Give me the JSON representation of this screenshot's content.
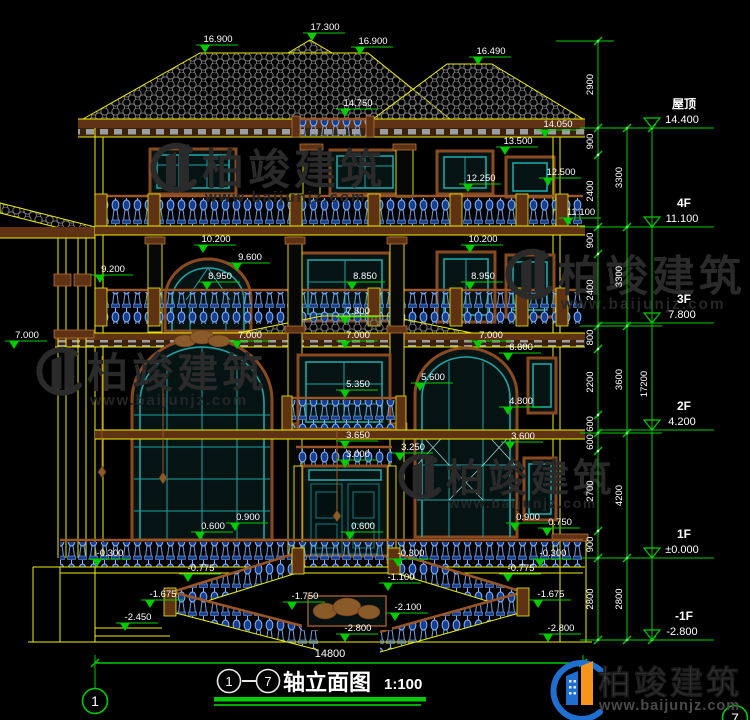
{
  "drawing": {
    "title": "轴立面图",
    "scale": "1:100",
    "axis_start": "1",
    "axis_end": "7",
    "axis_dash": "—",
    "bottom_dim": "14800"
  },
  "levels": [
    {
      "name": "屋顶",
      "value": "14.400",
      "y": 128
    },
    {
      "name": "4F",
      "value": "11.100",
      "y": 227
    },
    {
      "name": "3F",
      "value": "7.800",
      "y": 323
    },
    {
      "name": "2F",
      "value": "4.200",
      "y": 430
    },
    {
      "name": "1F",
      "value": "±0.000",
      "y": 558
    },
    {
      "name": "-1F",
      "value": "-2.800",
      "y": 640
    }
  ],
  "chains": [
    {
      "x": 598,
      "ticks": [
        41,
        128,
        155,
        227,
        254,
        326,
        349,
        415,
        433,
        451,
        531,
        558,
        640
      ],
      "labels": [
        "2900",
        "900",
        "2400",
        "900",
        "2400",
        "800",
        "2200",
        "600",
        "600",
        "2700",
        "900",
        "2800"
      ]
    },
    {
      "x": 627,
      "ticks": [
        128,
        227,
        326,
        433,
        558,
        640
      ],
      "labels": [
        "3300",
        "3300",
        "3600",
        "4200",
        "2800"
      ]
    },
    {
      "x": 652,
      "ticks": [
        128,
        640
      ],
      "labels": [
        "17200"
      ]
    }
  ],
  "ties": [
    {
      "y": 41,
      "x1": 556,
      "x2": 614
    },
    {
      "y": 128,
      "x1": 580,
      "x2": 662
    },
    {
      "y": 227,
      "x1": 580,
      "x2": 662
    },
    {
      "y": 326,
      "x1": 580,
      "x2": 662
    },
    {
      "y": 433,
      "x1": 580,
      "x2": 662
    },
    {
      "y": 558,
      "x1": 580,
      "x2": 662
    },
    {
      "y": 640,
      "x1": 580,
      "x2": 662
    }
  ],
  "elevation_marks": [
    {
      "l": "16.900",
      "x": 205,
      "y": 53
    },
    {
      "l": "17.300",
      "x": 312,
      "y": 41
    },
    {
      "l": "16.900",
      "x": 360,
      "y": 55
    },
    {
      "l": "16.490",
      "x": 478,
      "y": 65
    },
    {
      "l": "14.750",
      "x": 345,
      "y": 117
    },
    {
      "l": "14.050",
      "x": 545,
      "y": 138
    },
    {
      "l": "13.500",
      "x": 505,
      "y": 155
    },
    {
      "l": "12.500",
      "x": 548,
      "y": 186
    },
    {
      "l": "12.250",
      "x": 468,
      "y": 192
    },
    {
      "l": "11.100",
      "x": 568,
      "y": 226
    },
    {
      "l": "10.200",
      "x": 203,
      "y": 253
    },
    {
      "l": "10.200",
      "x": 470,
      "y": 253
    },
    {
      "l": "9.600",
      "x": 237,
      "y": 271
    },
    {
      "l": "9.200",
      "x": 100,
      "y": 283
    },
    {
      "l": "8.950",
      "x": 207,
      "y": 290
    },
    {
      "l": "8.850",
      "x": 352,
      "y": 290
    },
    {
      "l": "8.950",
      "x": 470,
      "y": 290
    },
    {
      "l": "7.800",
      "x": 345,
      "y": 325
    },
    {
      "l": "7.000",
      "x": 14,
      "y": 349
    },
    {
      "l": "7.000",
      "x": 237,
      "y": 349
    },
    {
      "l": "7.000",
      "x": 345,
      "y": 349
    },
    {
      "l": "7.000",
      "x": 478,
      "y": 349
    },
    {
      "l": "6.600",
      "x": 508,
      "y": 361
    },
    {
      "l": "5.600",
      "x": 420,
      "y": 391
    },
    {
      "l": "5.350",
      "x": 345,
      "y": 398
    },
    {
      "l": "4.800",
      "x": 508,
      "y": 415
    },
    {
      "l": "3.650",
      "x": 345,
      "y": 449
    },
    {
      "l": "3.600",
      "x": 510,
      "y": 450
    },
    {
      "l": "3.250",
      "x": 400,
      "y": 461
    },
    {
      "l": "3.000",
      "x": 345,
      "y": 468
    },
    {
      "l": "0.600",
      "x": 200,
      "y": 540
    },
    {
      "l": "0.900",
      "x": 235,
      "y": 531
    },
    {
      "l": "0.600",
      "x": 350,
      "y": 540
    },
    {
      "l": "0.900",
      "x": 515,
      "y": 531
    },
    {
      "l": "0.750",
      "x": 547,
      "y": 536
    },
    {
      "l": "-0.300",
      "x": 97,
      "y": 567
    },
    {
      "l": "-0.300",
      "x": 398,
      "y": 567
    },
    {
      "l": "-0.300",
      "x": 540,
      "y": 567
    },
    {
      "l": "-0.775",
      "x": 188,
      "y": 582
    },
    {
      "l": "-0.775",
      "x": 508,
      "y": 582
    },
    {
      "l": "-1.100",
      "x": 388,
      "y": 591
    },
    {
      "l": "-1.675",
      "x": 150,
      "y": 608
    },
    {
      "l": "-1.675",
      "x": 538,
      "y": 608
    },
    {
      "l": "-1.750",
      "x": 292,
      "y": 610
    },
    {
      "l": "-2.100",
      "x": 395,
      "y": 621
    },
    {
      "l": "-2.450",
      "x": 125,
      "y": 631
    },
    {
      "l": "-2.800",
      "x": 345,
      "y": 642
    },
    {
      "l": "-2.800",
      "x": 548,
      "y": 642
    }
  ],
  "bottom_dim_line": {
    "y": 663,
    "x1": 95,
    "x2": 583,
    "tx": 330,
    "ty": 657
  },
  "axis_markers": [
    {
      "n": "1",
      "cx": 95,
      "cy": 701,
      "lx": 95,
      "ly1": 656,
      "ly2": 688
    },
    {
      "n": "7",
      "cx": 735,
      "cy": 718
    }
  ],
  "watermark": {
    "brand": "柏竣建筑",
    "url": "www.baijunjz.com"
  },
  "watermarks_positions": [
    {
      "x": 150,
      "y": 142,
      "s": 1.0
    },
    {
      "x": 505,
      "y": 248,
      "s": 1.02
    },
    {
      "x": 36,
      "y": 346,
      "s": 0.98
    },
    {
      "x": 398,
      "y": 453,
      "s": 0.92
    }
  ],
  "footer": {
    "brand": "柏竣建筑",
    "url": "www.baijunjz.com"
  },
  "colors": {
    "dim_green": "#00cc00",
    "text_white": "#ffffff",
    "outline_yellow": "#f0f000",
    "trim_brown": "#9a5526",
    "window_teal": "#1fa3a3",
    "baluster_blue": "#1d4fa8",
    "watermark_gray": "#2a2a2a",
    "logo_blue": "#1f6fd0",
    "logo_orange": "#f7941d"
  }
}
